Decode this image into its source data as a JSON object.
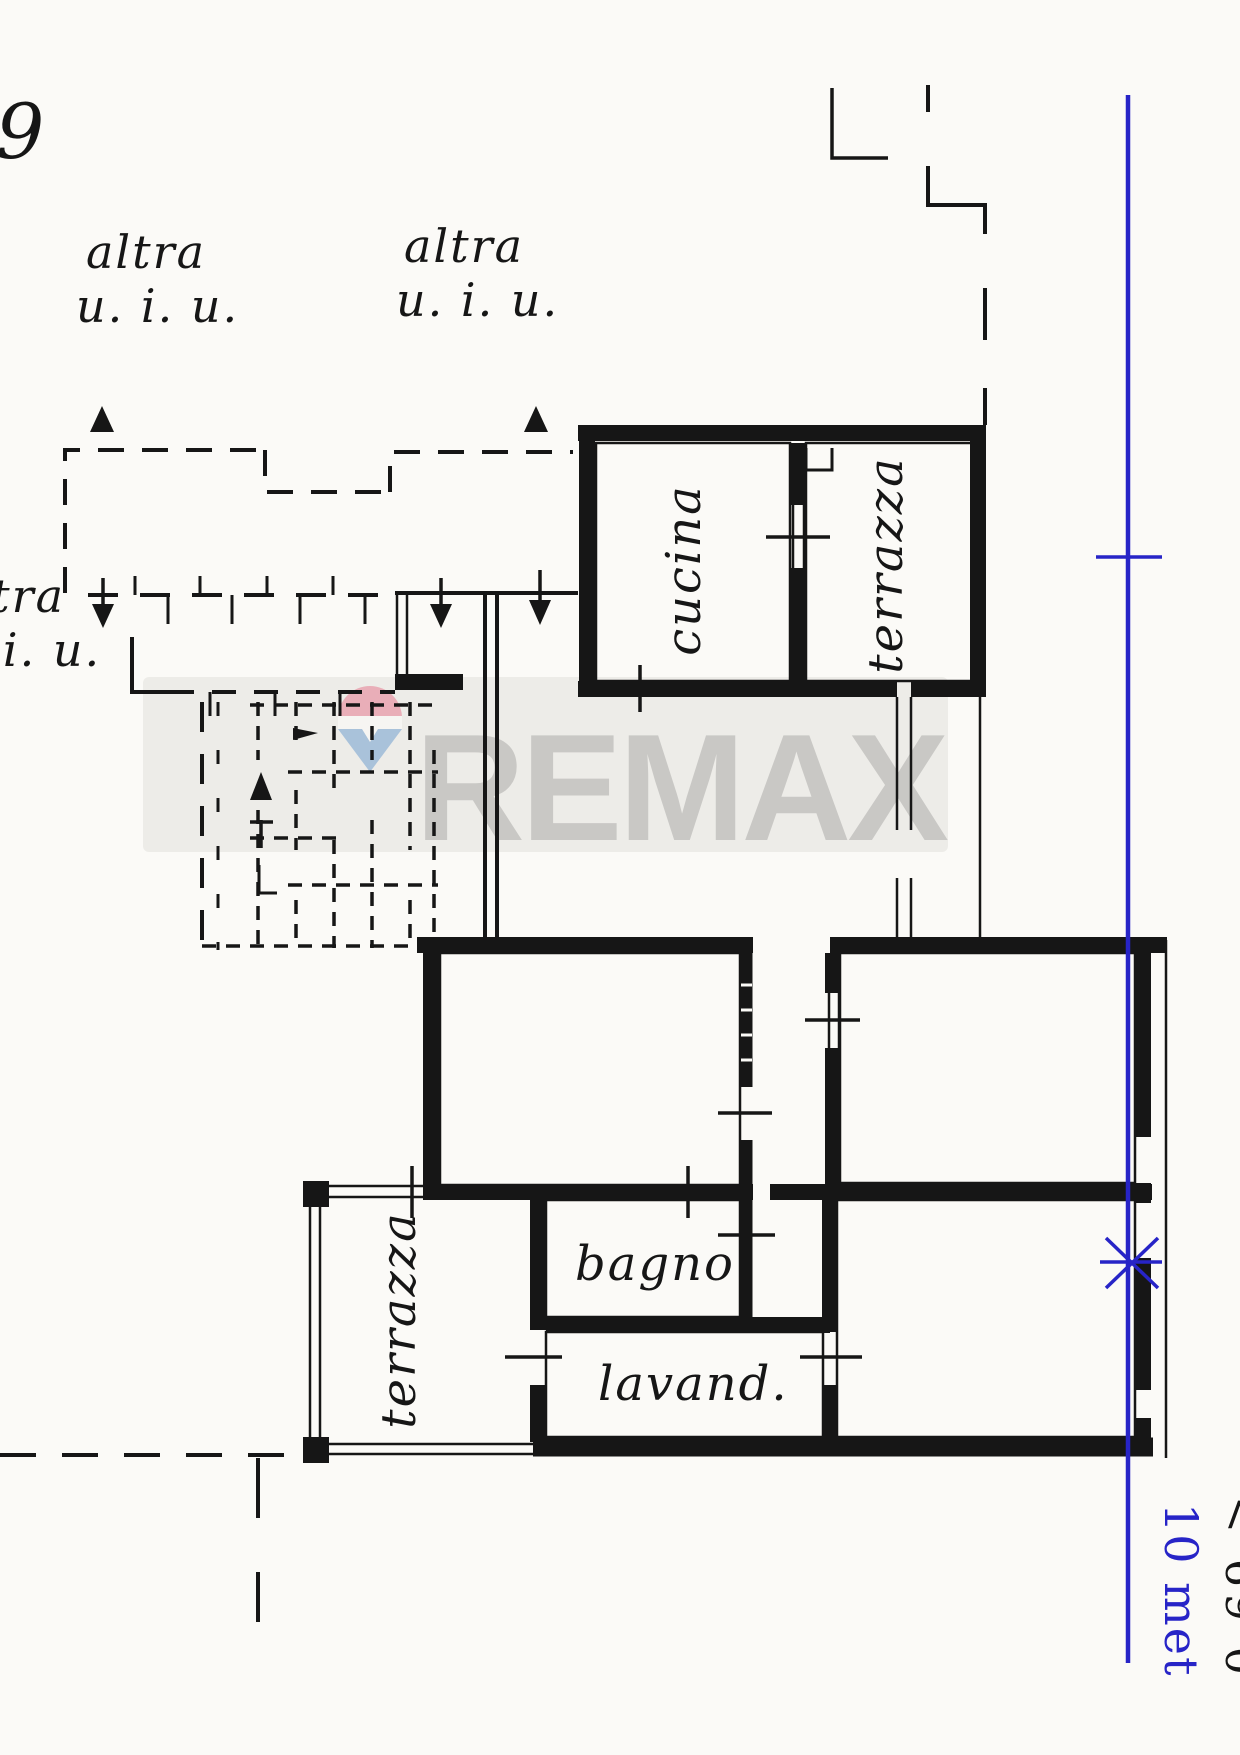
{
  "plan": {
    "sheet_number": "9",
    "unit_labels": [
      {
        "id": "top-left",
        "line1": "altra",
        "line2": "u. i. u."
      },
      {
        "id": "top-center",
        "line1": "altra",
        "line2": "u. i. u."
      },
      {
        "id": "left-edge",
        "line1": "altra",
        "line2": "u. i. u."
      }
    ],
    "rooms": {
      "kitchen": "cucina",
      "terrace_upper": "terrazza",
      "terrace_lower": "terrazza",
      "bathroom": "bagno",
      "laundry": "lavand."
    }
  },
  "watermark": {
    "brand": "REMAX",
    "band_color": "#edecE8",
    "letter_color": "#c9c8c5",
    "balloon_red": "#e9aeb8",
    "balloon_blue": "#a9c2da"
  },
  "measure": {
    "color": "#2724c7",
    "label": "10 met",
    "edge_label": "< 69 0"
  },
  "ink": "#161616",
  "background": "#fbfaf7"
}
